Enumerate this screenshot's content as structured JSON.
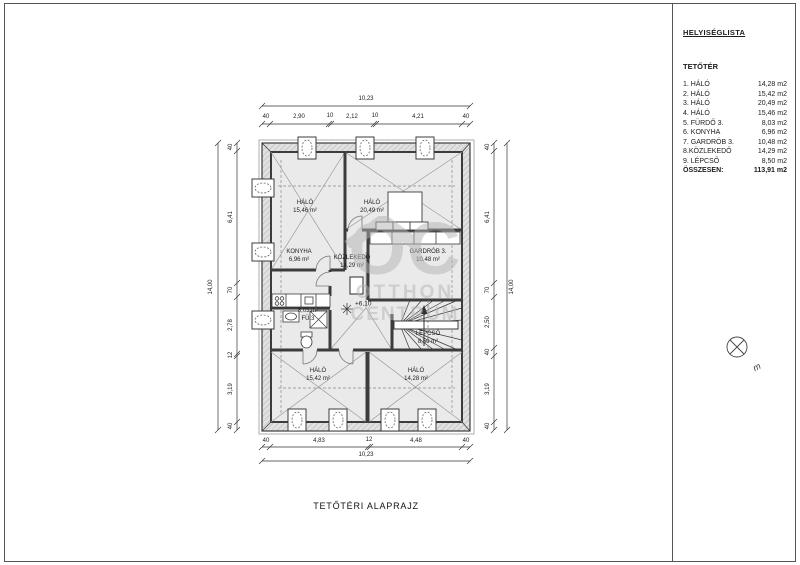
{
  "panel": {
    "title": "HELYISÉGLISTA",
    "section": "TETŐTÉR",
    "rooms": [
      {
        "name": "1. HÁLÓ",
        "area": "14,28 m2"
      },
      {
        "name": "2. HÁLÓ",
        "area": "15,42 m2"
      },
      {
        "name": "3. HÁLÓ",
        "area": "20,49 m2"
      },
      {
        "name": "4. HÁLÓ",
        "area": "15,46 m2"
      },
      {
        "name": "5. FÜRDŐ 3.",
        "area": "8,03 m2"
      },
      {
        "name": "6. KONYHA",
        "area": "6,96 m2"
      },
      {
        "name": "7. GARDRÓB 3.",
        "area": "10,48 m2"
      },
      {
        "name": "8.KÖZLEKEDŐ",
        "area": "14,29 m2"
      },
      {
        "name": "9. LÉPCSŐ",
        "area": "8,50 m2"
      }
    ],
    "total_label": "ÖSSZESEN:",
    "total_value": "113,91 m2"
  },
  "plan": {
    "rooms": [
      {
        "name": "HÁLÓ",
        "area": "15,46 m²"
      },
      {
        "name": "HÁLÓ",
        "area": "20,49 m²"
      },
      {
        "name": "KONYHA",
        "area": "6,96 m²"
      },
      {
        "name": "KÖZLEKEDŐ",
        "area": "14,29 m²"
      },
      {
        "name": "GARDRÓB 3.",
        "area": "10,48 m²"
      },
      {
        "name": "FÜ.3",
        "area": "8,03 m²"
      },
      {
        "name": "HÁLÓ",
        "area": "15,42 m²"
      },
      {
        "name": "HÁLÓ",
        "area": "14,28 m²"
      },
      {
        "name": "LÉPCSŐ",
        "area": "8,50 m²"
      }
    ],
    "level_marker": "+6,10"
  },
  "dimensions": {
    "top_total": "10,23",
    "top_segments": [
      "40",
      "2,90",
      "10",
      "2,12",
      "10",
      "4,21",
      "40"
    ],
    "bottom_segments": [
      "40",
      "4,83",
      "12",
      "4,48",
      "40"
    ],
    "bottom_total": "10,23",
    "left_total": "14,00",
    "left_segments": [
      "40",
      "6,41",
      "70",
      "2,78",
      "12",
      "3,19",
      "40"
    ],
    "right_segments": [
      "40",
      "6,41",
      "70",
      "2,50",
      "40",
      "3,19",
      "40"
    ],
    "right_total": "14,00"
  },
  "drawing_title": "TETŐTÉRI ALAPRAJZ",
  "watermark": {
    "monogram": "OC",
    "line1": "OTTHON",
    "line2": "CENTRUM"
  },
  "north_label": "m",
  "colors": {
    "wall": "#3c3c3c",
    "floor": "#eaeaea",
    "eave_hatch": "#b0b0b0",
    "watermark": "#b3b3b3"
  }
}
